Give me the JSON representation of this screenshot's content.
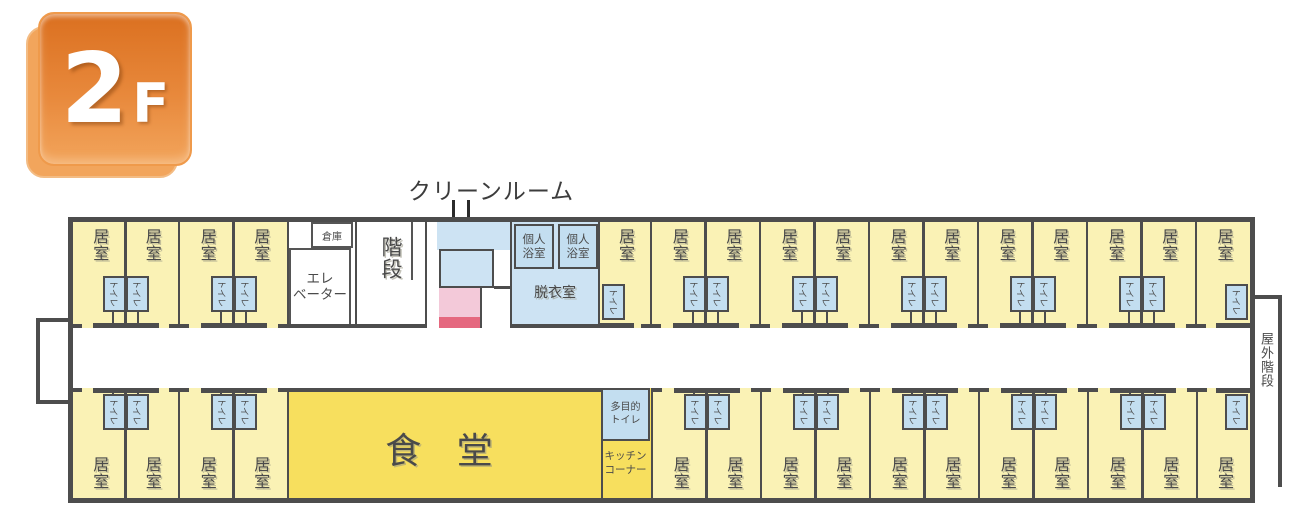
{
  "badge": {
    "number": "2",
    "suffix": "F"
  },
  "annotations": {
    "clean_room": "クリーンルーム",
    "care_station": "ケアステーション",
    "outdoor_stairs": "屋外階段"
  },
  "labels": {
    "resident_room": "居室",
    "toilet": "トイレ",
    "storage": "倉庫",
    "elevator": [
      "エレ",
      "ベーター"
    ],
    "stairs": "階段",
    "private_bath": [
      "個人",
      "浴室"
    ],
    "changing_room": "脱衣室",
    "dining_hall": "食 堂",
    "multipurpose_toilet": [
      "多目的",
      "トイレ"
    ],
    "kitchen_corner": [
      "キッチン",
      "コーナー"
    ]
  },
  "colors": {
    "wall": "#4d4d4d",
    "room_yellow": "#faf2b5",
    "dining_yellow": "#f7df5e",
    "water_blue": "#c3def0",
    "water_blue_light": "#cde3f3",
    "care_pink": "#f3c9d9",
    "care_red": "#e5687f",
    "badge_top": "#db7020",
    "badge_bottom": "#f2a55c"
  },
  "floor_layout": {
    "top_row": [
      {
        "type": "pair",
        "w": 105
      },
      {
        "type": "pair",
        "w": 109
      },
      {
        "type": "core",
        "w": 68
      },
      {
        "type": "stairs",
        "w": 70
      },
      {
        "type": "clean",
        "w": 85
      },
      {
        "type": "bath",
        "w": 88
      },
      {
        "type": "single",
        "w": 52,
        "toilet": "left"
      },
      {
        "type": "pair",
        "w": 109
      },
      {
        "type": "pair",
        "w": 109
      },
      {
        "type": "pair",
        "w": 109
      },
      {
        "type": "pair",
        "w": 109
      },
      {
        "type": "pair",
        "w": 109
      },
      {
        "type": "single",
        "w": 55,
        "toilet": "right"
      }
    ],
    "bottom_row": [
      {
        "type": "pair",
        "w": 105
      },
      {
        "type": "pair",
        "w": 109
      },
      {
        "type": "dining",
        "w": 314
      },
      {
        "type": "kitchen",
        "w": 50
      },
      {
        "type": "pair",
        "w": 109
      },
      {
        "type": "pair",
        "w": 109
      },
      {
        "type": "pair",
        "w": 109
      },
      {
        "type": "pair",
        "w": 109
      },
      {
        "type": "pair",
        "w": 109
      },
      {
        "type": "single",
        "w": 54,
        "toilet": "right"
      }
    ]
  }
}
